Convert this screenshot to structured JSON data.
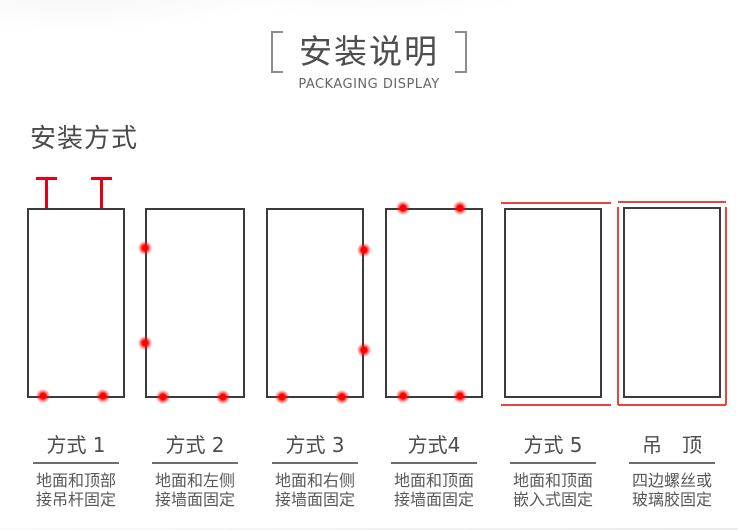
{
  "header": {
    "title": "安装说明",
    "subtitle": "PACKAGING DISPLAY"
  },
  "section_title": "安装方式",
  "methods": [
    {
      "name": "方式 1",
      "desc_line1": "地面和顶部",
      "desc_line2": "接吊杆固定",
      "fixture": "two-hanging-rods-on-top, two-fix-dots-on-bottom"
    },
    {
      "name": "方式 2",
      "desc_line1": "地面和左侧",
      "desc_line2": "接墙面固定",
      "fixture": "two-fix-dots-on-left-edge, two-fix-dots-on-bottom"
    },
    {
      "name": "方式 3",
      "desc_line1": "地面和右侧",
      "desc_line2": "接墙面固定",
      "fixture": "two-fix-dots-on-right-edge, two-fix-dots-on-bottom"
    },
    {
      "name": "方式4",
      "desc_line1": "地面和顶面",
      "desc_line2": "接墙面固定",
      "fixture": "two-fix-dots-on-top, two-fix-dots-on-bottom"
    },
    {
      "name": "方式 5",
      "desc_line1": "地面和顶面",
      "desc_line2": "嵌入式固定",
      "fixture": "red-recess-lines-top-and-bottom"
    },
    {
      "name": "吊　顶",
      "desc_line1": "四边螺丝或",
      "desc_line2": "玻璃胶固定",
      "fixture": "red-lines-on-all-four-sides"
    }
  ],
  "colors": {
    "accent_red": "#e60012",
    "dot_red": "#ff0000",
    "outline_dark": "#3b3b3b",
    "text_gray": "#595757"
  }
}
